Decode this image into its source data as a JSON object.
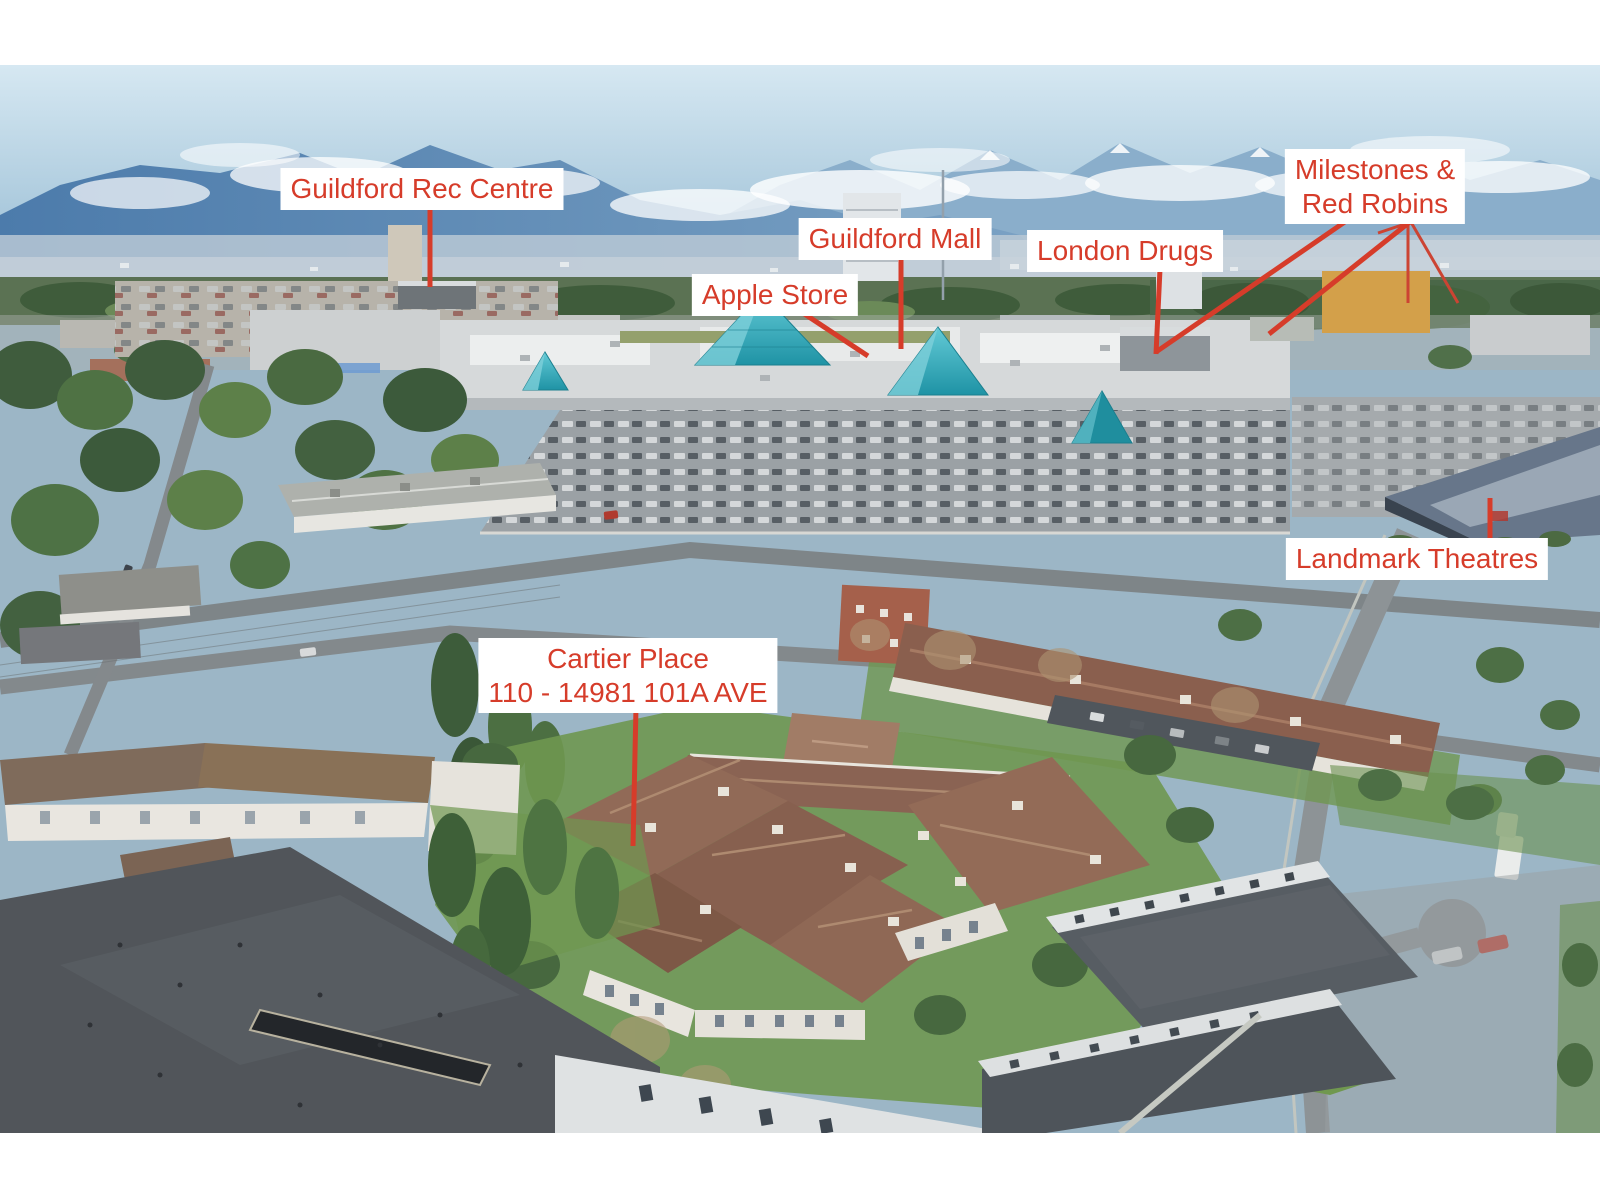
{
  "annotations": {
    "text_color": "#d63c2a",
    "box_background": "#ffffff",
    "items": [
      {
        "id": "guildford-rec-centre",
        "lines": [
          "Guildford Rec Centre"
        ]
      },
      {
        "id": "guildford-mall",
        "lines": [
          "Guildford Mall"
        ]
      },
      {
        "id": "apple-store",
        "lines": [
          "Apple Store"
        ]
      },
      {
        "id": "london-drugs",
        "lines": [
          "London Drugs"
        ]
      },
      {
        "id": "milestones-red-robins",
        "lines": [
          "Milestones &",
          "Red Robins"
        ]
      },
      {
        "id": "landmark-theatres",
        "lines": [
          "Landmark Theatres"
        ]
      },
      {
        "id": "cartier-place",
        "lines": [
          "Cartier Place",
          "110 - 14981 101A AVE"
        ]
      }
    ]
  },
  "scene_colors": {
    "sky": "#cde2ef",
    "mountains": "#5c86b2",
    "trees": "#4e6f46",
    "mall_roof": "#d6d9da",
    "pyramid_glass": "#2fa9b8",
    "asphalt": "#9aa0a4",
    "subject_roof_brown": "#8a6353",
    "charcoal_roof": "#51555a",
    "grass": "#6f9750"
  }
}
